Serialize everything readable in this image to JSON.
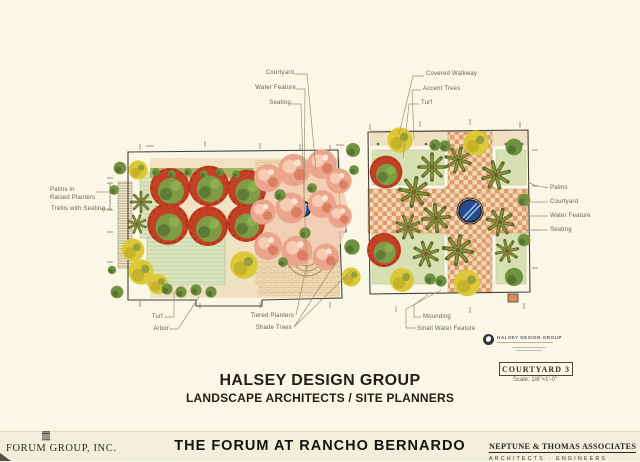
{
  "colors": {
    "page_bg": "#fbf7e7",
    "footer_bg": "#f3eedb",
    "label_text": "#6a6152",
    "leader_line": "#9b8f74",
    "canopy_red": "#c24024",
    "foliage_green": "#7d9c45",
    "flower_pink": "#eba58c",
    "shrub_yellow": "#ddc937",
    "turf_green": "#dbe5c2",
    "paving_tan": "#efe0c2",
    "paving_terracotta": "#e09c68",
    "water_blue": "#274b8e",
    "palm_olive": "#5c6a28"
  },
  "annotations": {
    "left_plan_top": [
      "Courtyard",
      "Water Feature",
      "Seating"
    ],
    "right_plan_top": [
      "Covered Walkway",
      "Accent Trees",
      "Turf"
    ],
    "left_side": [
      "Palms in Raised Planters",
      "Trellis with Seating"
    ],
    "right_side": [
      "Palms",
      "Courtyard",
      "Water Feature",
      "Seating"
    ],
    "left_plan_bottom": [
      "Turf",
      "Arbor"
    ],
    "center_bottom": [
      "Tiered Planters",
      "Shade Trees"
    ],
    "right_plan_bottom": [
      "Mounding",
      "Small Water Feature"
    ]
  },
  "title_block": {
    "firm": "HALSEY DESIGN GROUP",
    "firm_subtitle": "LANDSCAPE ARCHITECTS / SITE PLANNERS",
    "drawing_name": "COURTYARD 3",
    "drawing_scale": "Scale: 1/8\"=1'-0\"",
    "stamp_title": "HALSEY DESIGN GROUP"
  },
  "footer": {
    "client": "FORUM GROUP, INC.",
    "project": "THE FORUM AT RANCHO BERNARDO",
    "architect": "NEPTUNE & THOMAS ASSOCIATES",
    "architect_subtitle": "ARCHITECTS · ENGINEERS"
  }
}
